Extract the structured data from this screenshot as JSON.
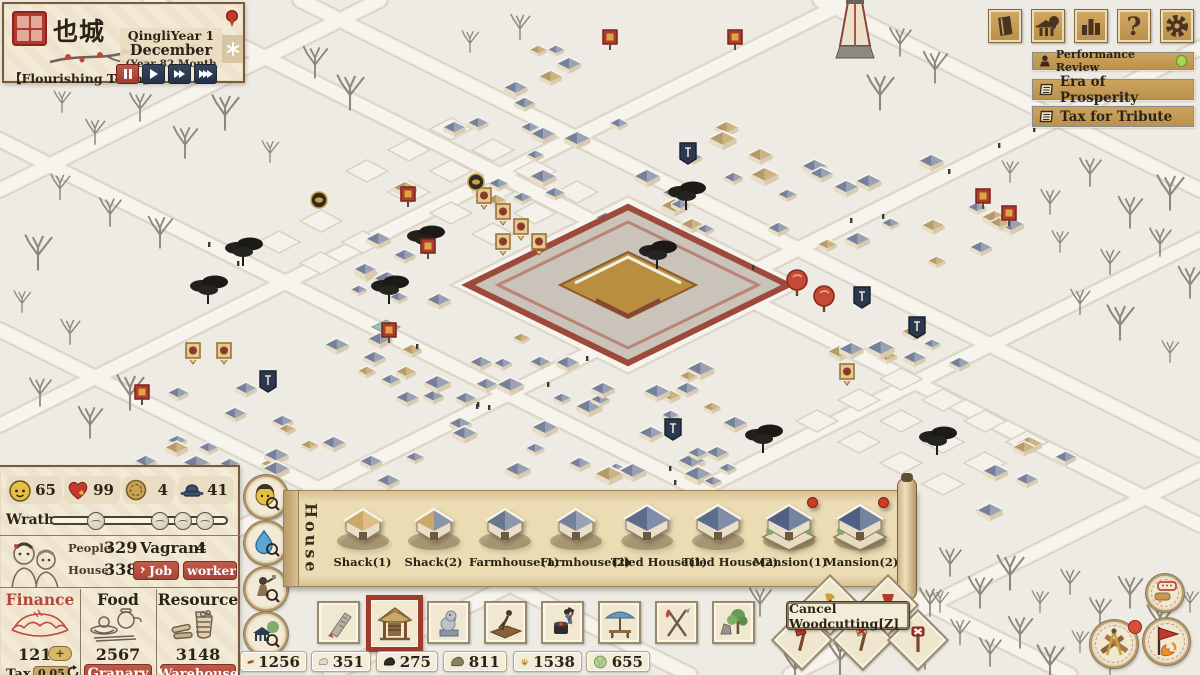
{
  "town_panel": {
    "town_name": "也城",
    "era_line": "QingliYear 1",
    "month_line": "December",
    "detail_line": "(Year 82 Month",
    "town_title": "【Flourishing Town】"
  },
  "top_menu": {
    "help_glyph": "?"
  },
  "quests": [
    {
      "label": "Performance Review",
      "has_status_dot": true
    },
    {
      "label": "Era of Prosperity",
      "has_status_dot": false
    },
    {
      "label": "Tax for Tribute",
      "has_status_dot": false
    }
  ],
  "stats": {
    "happiness": "65",
    "health": "99",
    "coin": "4",
    "official": "41"
  },
  "wrath": {
    "label": "Wrath",
    "markers": [
      25,
      62,
      75,
      88
    ]
  },
  "population": {
    "people_label": "People",
    "people": "329",
    "vagrant_label": "Vagrant",
    "vagrant": "4",
    "house_label": "House",
    "house": "338",
    "job_button": "Job",
    "worker_button": "worker"
  },
  "finance": {
    "title": "Finance",
    "value": "121",
    "tax_label": "Tax",
    "tax_rate": "0.05"
  },
  "food": {
    "title": "Food",
    "value": "2567",
    "button": "Granary"
  },
  "resource": {
    "title": "Resource",
    "value": "3148",
    "button": "Warehouse"
  },
  "build_menu": {
    "category": "House",
    "items": [
      {
        "label": "Shack(1)",
        "badge": false
      },
      {
        "label": "Shack(2)",
        "badge": false
      },
      {
        "label": "Farmhouse(1)",
        "badge": false
      },
      {
        "label": "Farmhouse(2)",
        "badge": false
      },
      {
        "label": "Tiled House(1)",
        "badge": false
      },
      {
        "label": "Tiled House(2)",
        "badge": false
      },
      {
        "label": "Mansion(1)",
        "badge": true
      },
      {
        "label": "Mansion(2)",
        "badge": true
      }
    ]
  },
  "toolbar": {
    "categories": [
      "road",
      "house",
      "decoration",
      "farming",
      "workshop",
      "commerce",
      "tools",
      "nature"
    ],
    "selected": "house"
  },
  "resource_bar": [
    {
      "name": "wood",
      "value": "1256"
    },
    {
      "name": "stone",
      "value": "351"
    },
    {
      "name": "coal",
      "value": "275"
    },
    {
      "name": "clay",
      "value": "811"
    },
    {
      "name": "straw",
      "value": "1538"
    },
    {
      "name": "vegetable",
      "value": "655"
    }
  ],
  "tooltip": {
    "text": "Cancel Woodcutting[Z]"
  },
  "colors": {
    "accent_red": "#b5473a",
    "navy": "#2c3a50",
    "gold": "#c89a55",
    "status_green": "#a6d94e"
  }
}
